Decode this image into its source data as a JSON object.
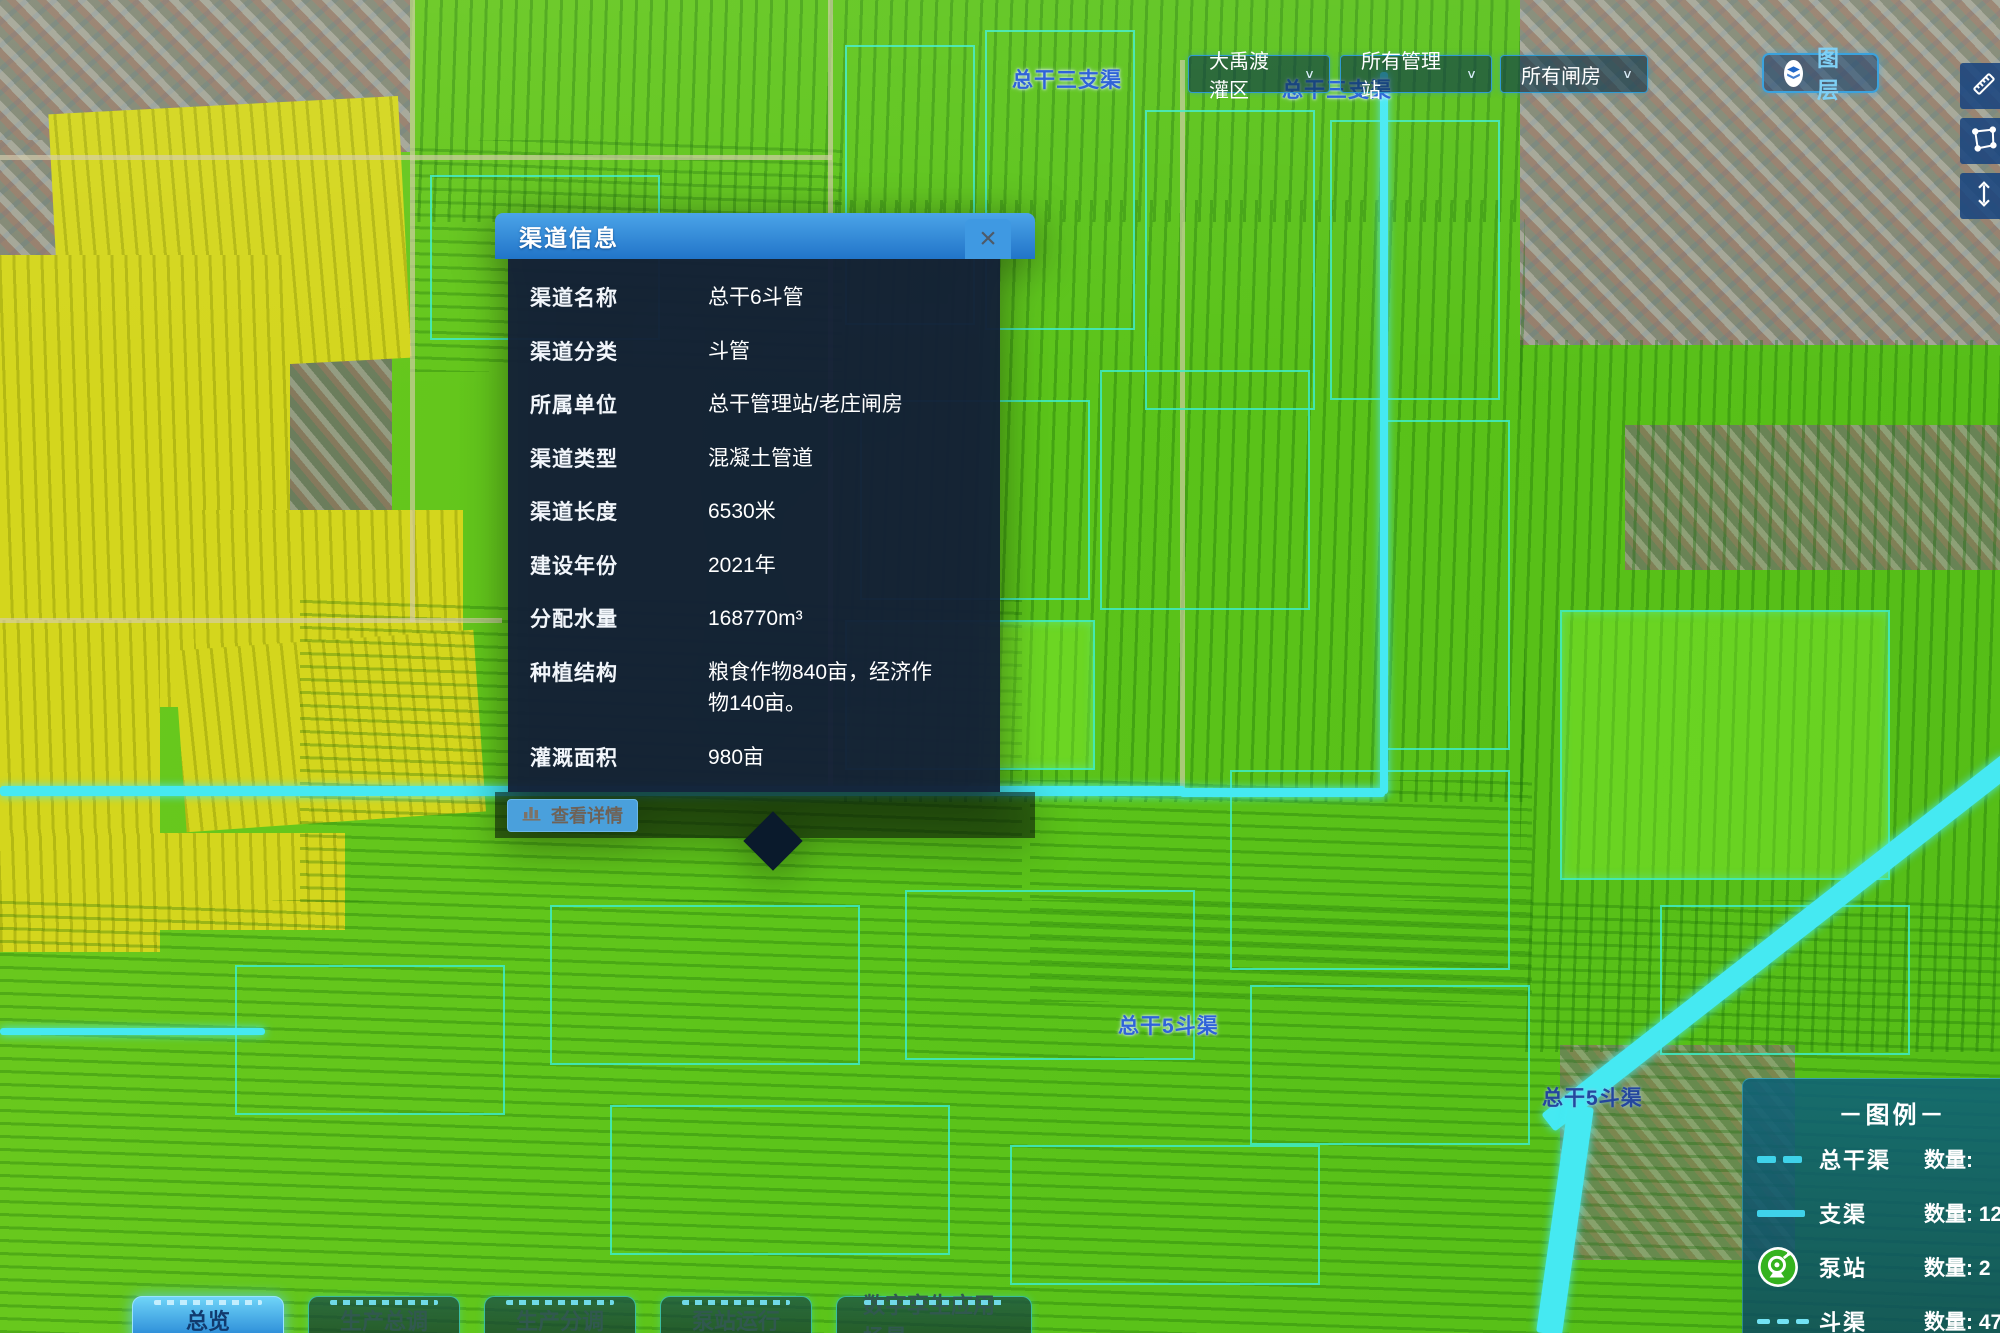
{
  "topbar": {
    "district_select": "大禹渡灌区",
    "station_select": "所有管理站",
    "gate_select": "所有闸房",
    "layers_button": "图 层"
  },
  "map_labels": {
    "canal_top_1": "总干三支渠",
    "canal_top_2": "总干三支渠",
    "canal_bottom_1": "总干5斗渠",
    "canal_bottom_2": "总干5斗渠"
  },
  "popup": {
    "title": "渠道信息",
    "close": "×",
    "rows": [
      {
        "label": "渠道名称",
        "value": "总干6斗管"
      },
      {
        "label": "渠道分类",
        "value": "斗管"
      },
      {
        "label": "所属单位",
        "value": "总干管理站/老庄闸房"
      },
      {
        "label": "渠道类型",
        "value": "混凝土管道"
      },
      {
        "label": "渠道长度",
        "value": "6530米"
      },
      {
        "label": "建设年份",
        "value": "2021年"
      },
      {
        "label": "分配水量",
        "value": "168770m³"
      },
      {
        "label": "种植结构",
        "value": "粮食作物840亩，经济作物140亩。"
      },
      {
        "label": "灌溉面积",
        "value": "980亩"
      }
    ],
    "detail_button": "查看详情"
  },
  "legend": {
    "title": "－图例－",
    "items": [
      {
        "name": "总干渠",
        "count_text": "数量: "
      },
      {
        "name": "支渠",
        "count_text": "数量: 12"
      },
      {
        "name": "泵站",
        "count_text": "数量: 2"
      },
      {
        "name": "斗渠",
        "count_text": "数量: 47"
      }
    ]
  },
  "tabs": [
    {
      "label": "总览",
      "active": true
    },
    {
      "label": "生产总调",
      "active": false
    },
    {
      "label": "生产分调",
      "active": false
    },
    {
      "label": "泵站运行",
      "active": false
    },
    {
      "label": "数字孪生应用场景",
      "active": false
    }
  ],
  "colors": {
    "accent_cyan": "#3fd2ea",
    "header_blue": "#2e83d4",
    "field_green": "#5cc41a",
    "highlight_parcel": "#3ce8c8",
    "pump_green": "#35b31e"
  }
}
